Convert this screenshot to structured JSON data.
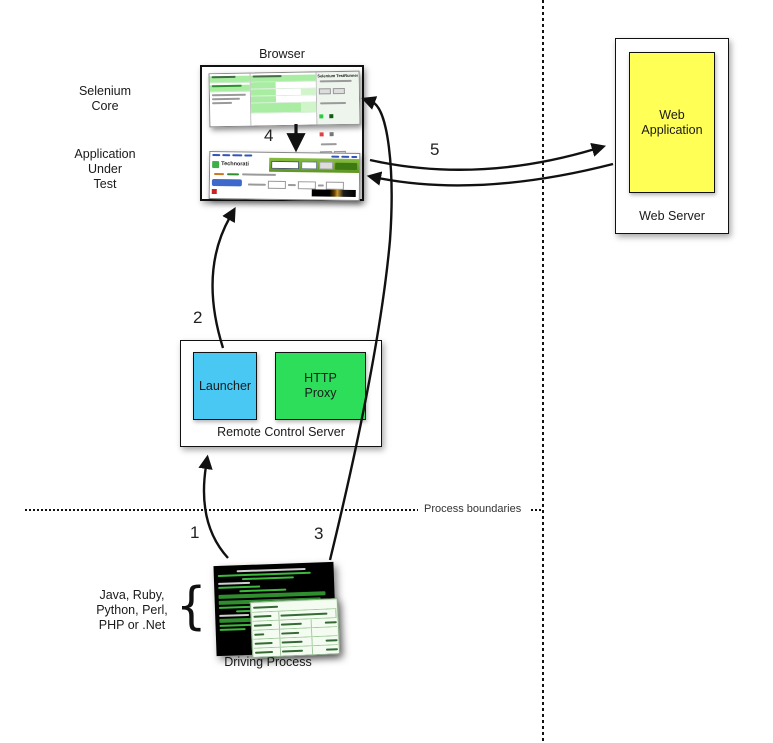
{
  "labels": {
    "browser": "Browser",
    "web_server": "Web Server",
    "web_application": "Web Application",
    "remote_control_server": "Remote Control Server",
    "launcher": "Launcher",
    "http_proxy": "HTTP Proxy",
    "driving_process": "Driving Process",
    "process_boundaries": "Process boundaries",
    "selenium_core": [
      "Selenium",
      "Core"
    ],
    "application_under_test": [
      "Application",
      "Under",
      "Test"
    ],
    "languages": [
      "Java, Ruby,",
      "Python, Perl,",
      "PHP or .Net"
    ],
    "brace": "{"
  },
  "steps": {
    "s1": "1",
    "s2": "2",
    "s3": "3",
    "s4": "4",
    "s5": "5"
  },
  "screenshots": {
    "testrunner_title": "Selenium TestRunner",
    "technorati_logo": "Technorati"
  },
  "colors": {
    "launcher_box": "#49C8F3",
    "http_proxy_box": "#2CDE5A",
    "web_application_box": "#FFFF55",
    "line_color": "#111111"
  }
}
